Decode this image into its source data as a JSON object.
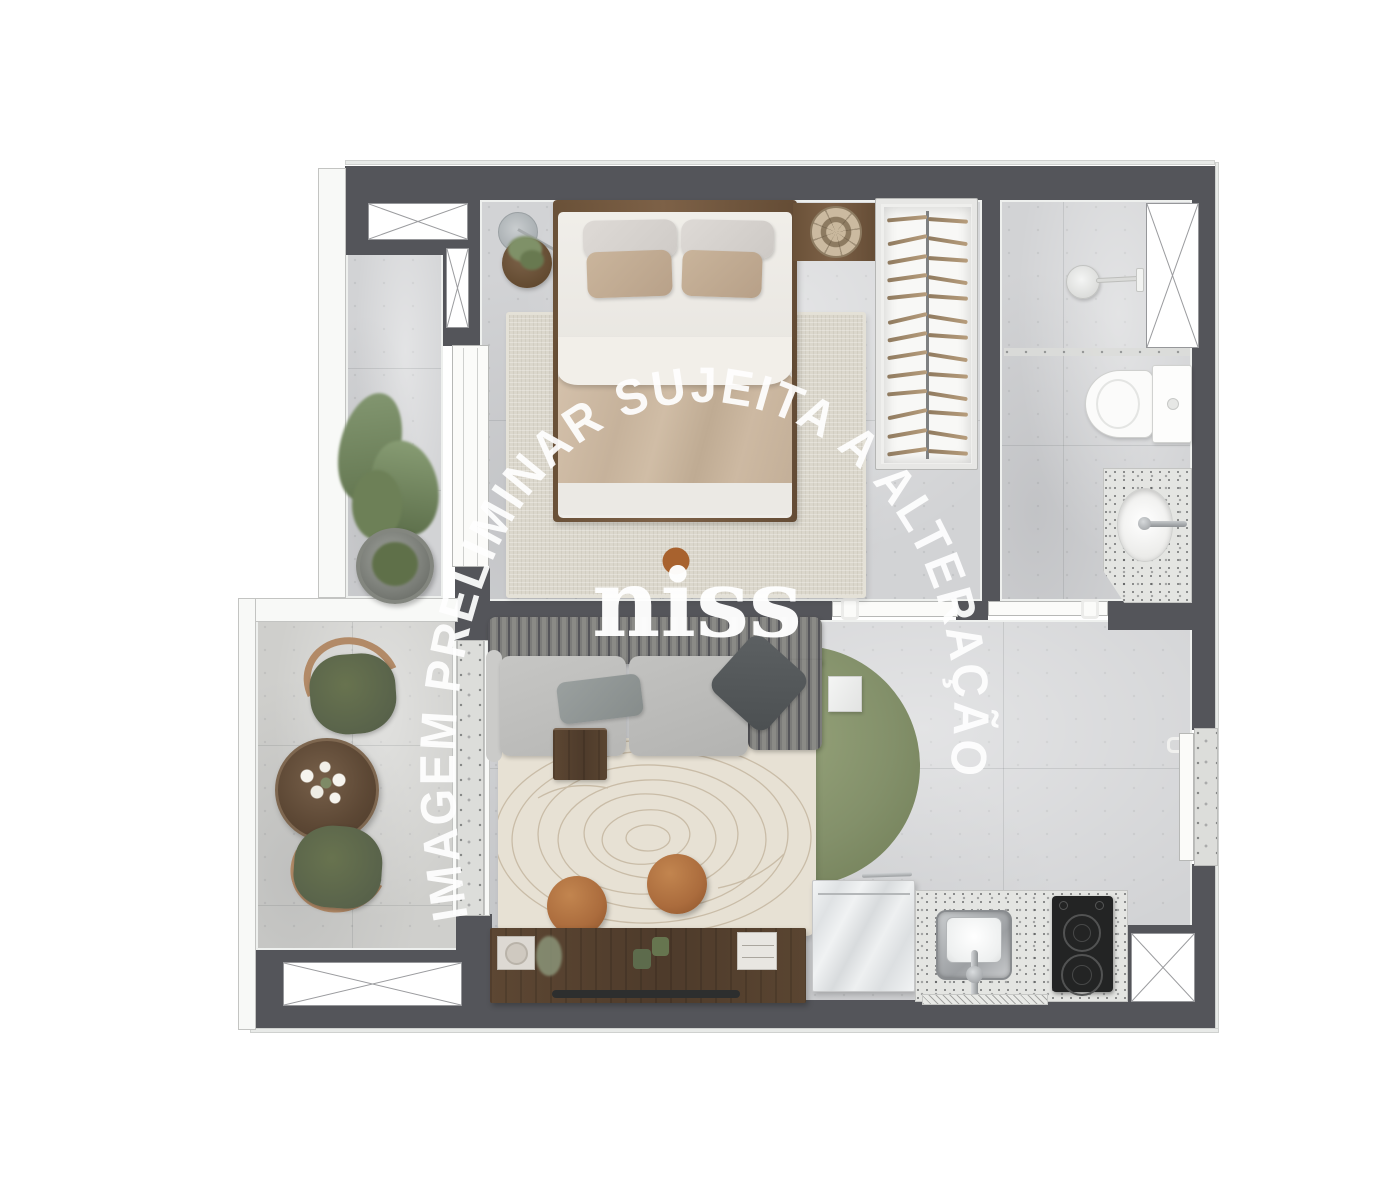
{
  "meta": {
    "kind": "apartment floor plan render (top-down)",
    "brand_visible": true
  },
  "watermark": {
    "arc_text": "IMAGEM PRELIMINAR SUJEITA A ALTERAÇÃO",
    "brand": "niss",
    "brand_dot_color": "#A8622E",
    "text_color": "#FFFFFF"
  },
  "closet": {
    "hanger_count": 13
  },
  "plan": {
    "rooms": [
      {
        "name": "bedroom",
        "furniture": [
          "double-bed",
          "four-pillows",
          "beige-duvet",
          "round-nightstand-with-plant",
          "floor-lamp",
          "woven-area-rug",
          "headboard-shelf",
          "rattan-pendant"
        ]
      },
      {
        "name": "closet",
        "furniture": [
          "open-wardrobe-with-hangers"
        ]
      },
      {
        "name": "bathroom",
        "furniture": [
          "shower-head",
          "toilet",
          "granite-sink-counter"
        ],
        "window": true
      },
      {
        "name": "living-room",
        "furniture": [
          "ribbed-back-sofa",
          "gray-cushions",
          "round-green-rug",
          "cream-contour-rug",
          "two-terracotta-poufs",
          "wood-side-stool",
          "marble-side-table",
          "tv-console-with-soundbar"
        ]
      },
      {
        "name": "kitchen",
        "furniture": [
          "marble-cabinet",
          "granite-counter",
          "steel-sink",
          "two-burner-cooktop"
        ],
        "window": true
      },
      {
        "name": "balcony",
        "furniture": [
          "two-green-chairs",
          "round-wood-table-with-flowers",
          "potted-plant"
        ],
        "window": true
      }
    ],
    "windows_count": 5,
    "doors": [
      "corridor-glass-door",
      "balcony-sliding-door",
      "bedroom-sliding-door",
      "bathroom-sliding-door",
      "entry-door"
    ]
  },
  "palette": {
    "wall": "#54555A",
    "floor_concrete": "#D2D3D5",
    "floor_balcony": "#CFCFCC",
    "rug_green": "#86936A",
    "rug_cream": "#E7E1D4",
    "wood_dark": "#55402E",
    "wood_mid": "#7B5F45",
    "terracotta": "#AB6C3D",
    "chair_green": "#5F694D",
    "sofa_gray": "#BDBDBB",
    "watermark": "#FFFFFF",
    "logo_dot": "#A8622E"
  }
}
